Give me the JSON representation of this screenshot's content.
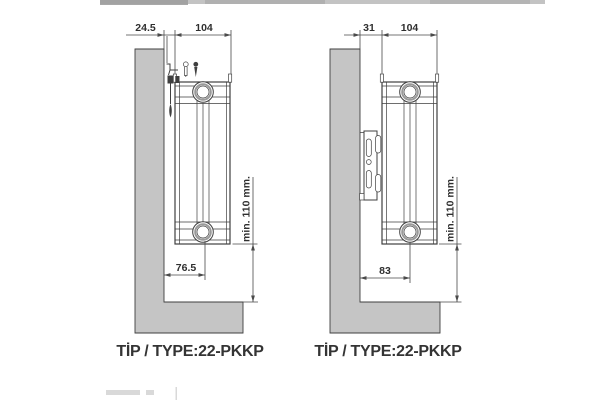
{
  "drawings": {
    "left": {
      "top_dims": {
        "wall_gap": "24.5",
        "depth": "104"
      },
      "bottom_dim": "76.5",
      "height_dim": "min. 110 mm.",
      "type_label": "TİP / TYPE:22-PKKP"
    },
    "right": {
      "top_dims": {
        "wall_gap": "31",
        "depth": "104"
      },
      "bottom_dim": "83",
      "height_dim": "min. 110 mm.",
      "type_label": "TİP / TYPE:22-PKKP"
    }
  },
  "colors": {
    "wall_fill": "#c5c5c5",
    "line_dark": "#3f3f3f",
    "dim_line": "#4a4a4a",
    "label_text": "#343434"
  }
}
